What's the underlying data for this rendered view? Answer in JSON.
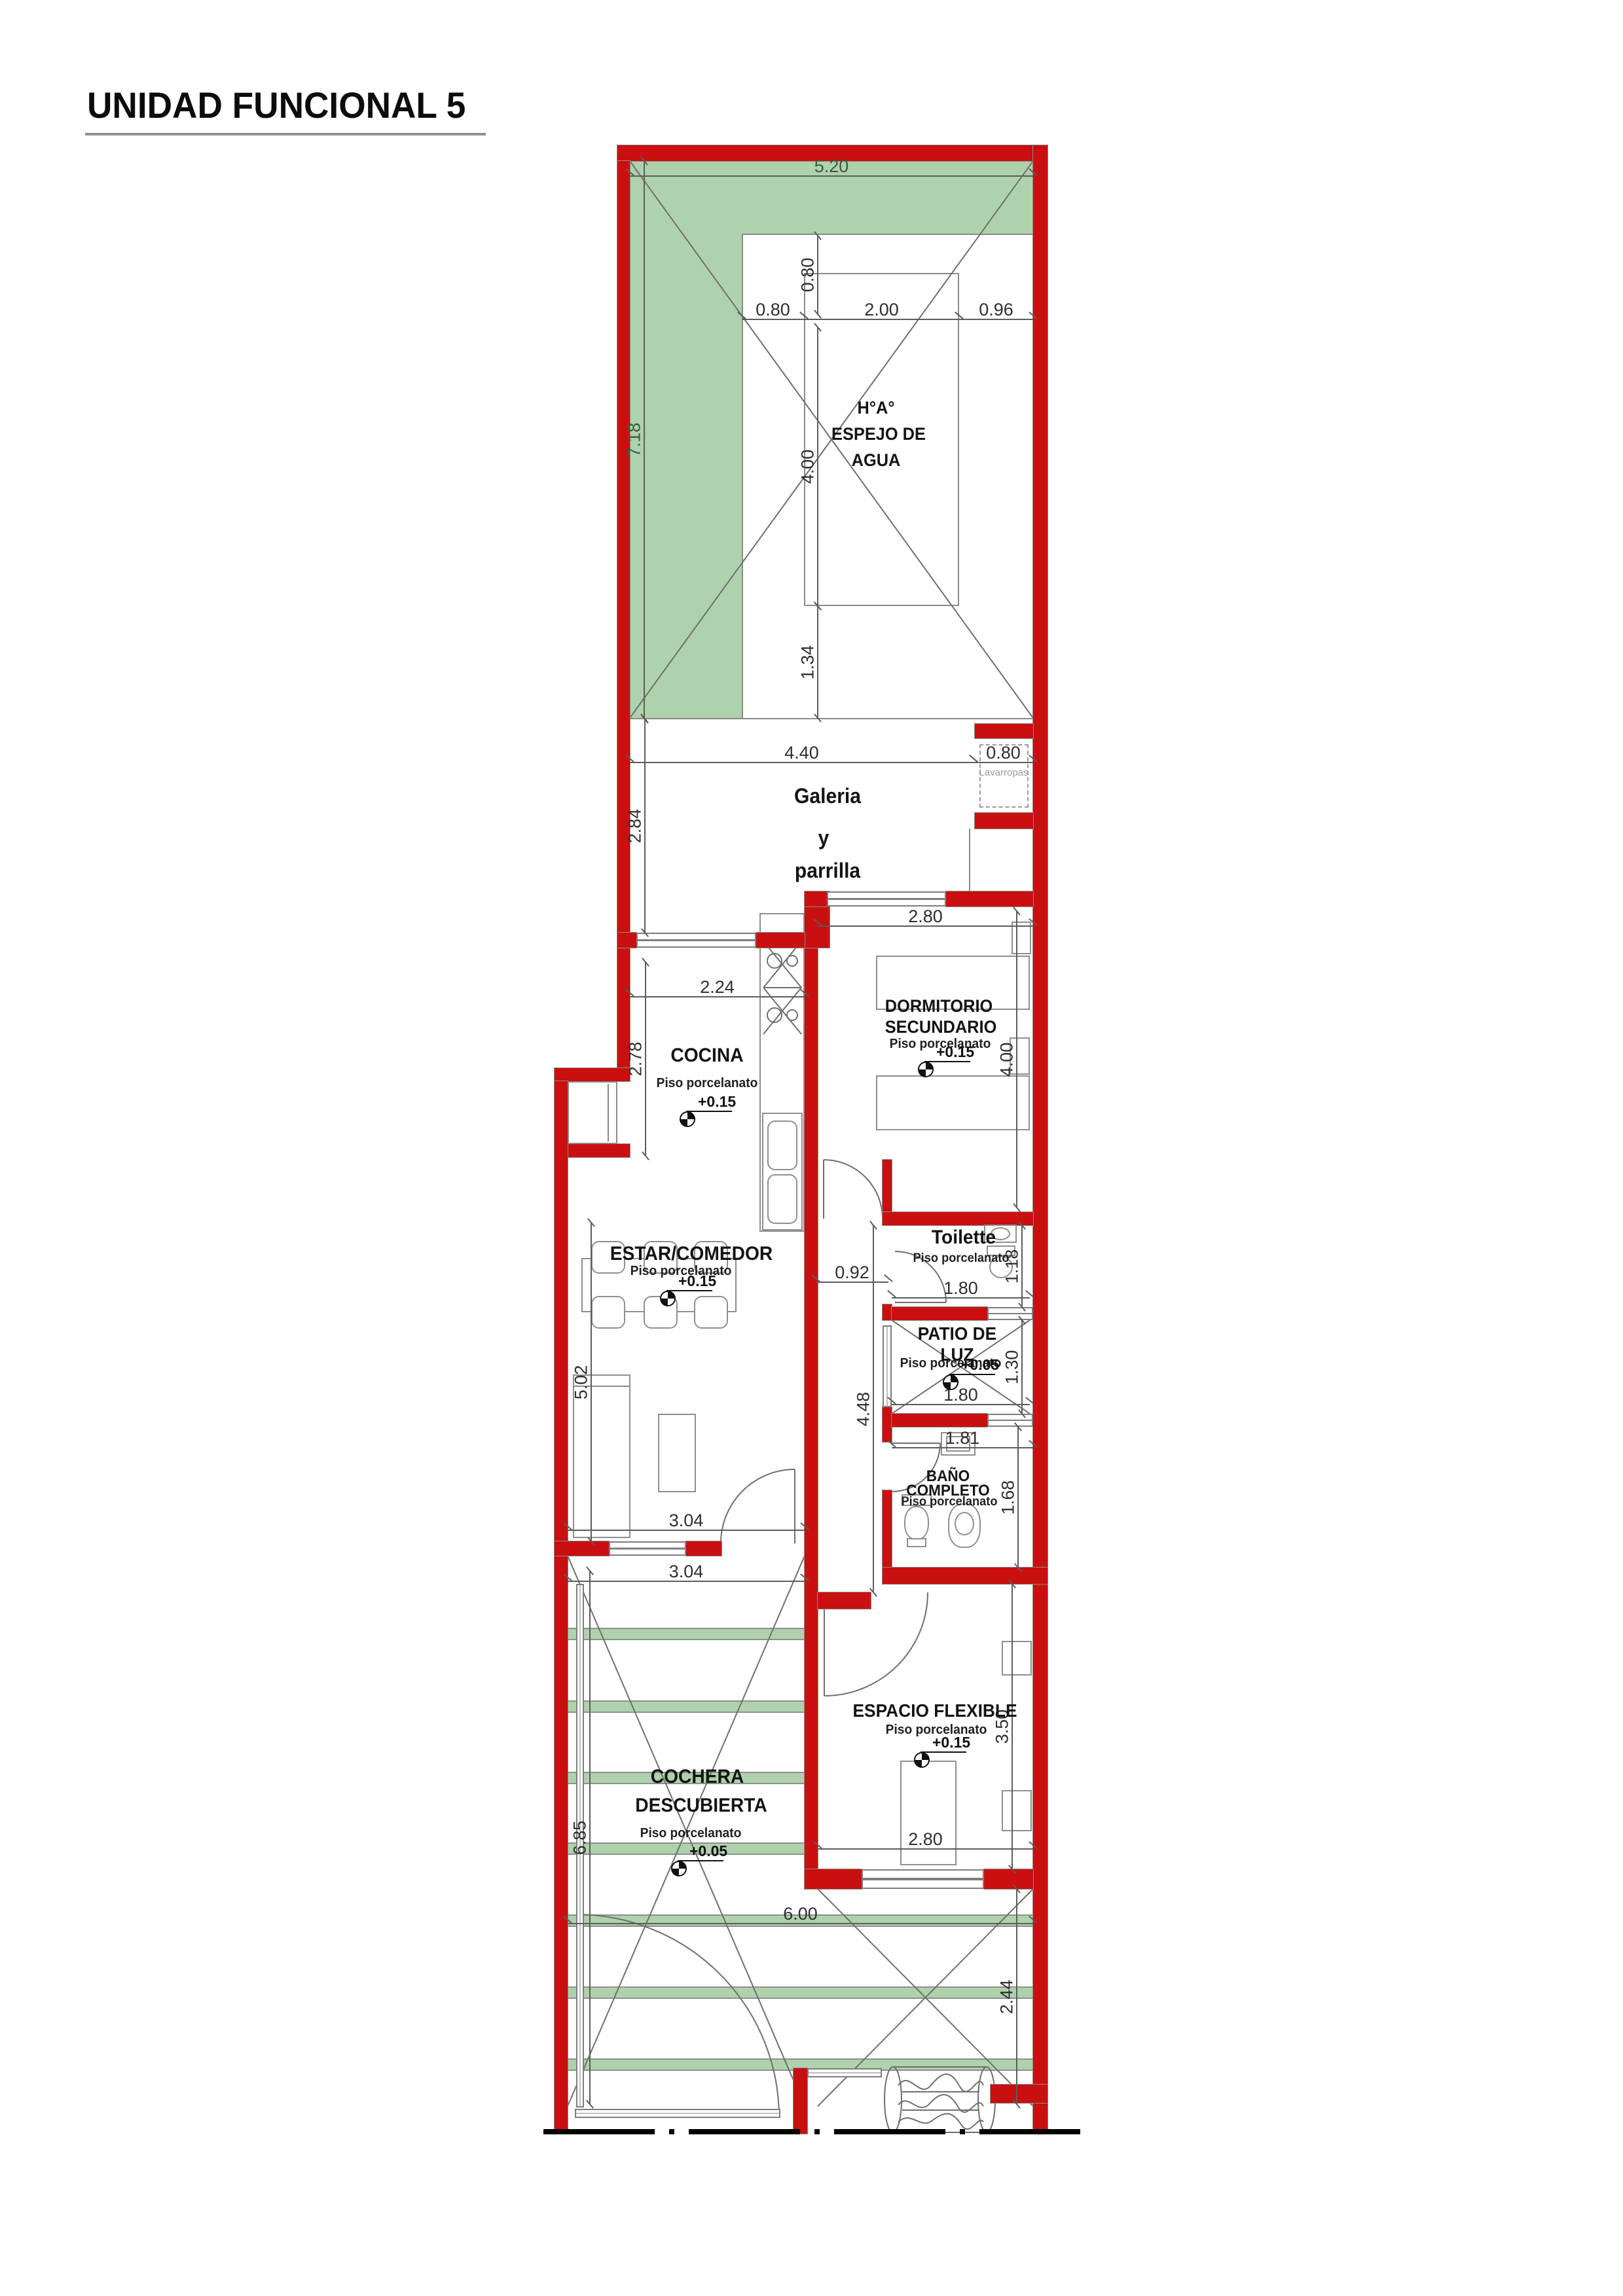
{
  "title": {
    "text": "UNIDAD FUNCIONAL 5"
  },
  "colors": {
    "wall_red": "#c90f0f",
    "terrace_green": "#aed2ab",
    "line_gray": "#8a8a8a",
    "dim_gray": "#5c5c5c"
  },
  "rooms": {
    "espejo": {
      "line1": "H°A°",
      "line2": "ESPEJO DE",
      "line3": "AGUA"
    },
    "galeria": {
      "line1": "Galeria",
      "line2": "y",
      "line3": "parrilla"
    },
    "lavarropas": {
      "label": "Lavarropas"
    },
    "cocina": {
      "name": "COCINA",
      "floor": "Piso porcelanato",
      "level": "+0.15"
    },
    "dormitorio": {
      "name1": "DORMITORIO",
      "name2": "SECUNDARIO",
      "floor": "Piso porcelanato",
      "level": "+0.15"
    },
    "estar": {
      "name": "ESTAR/COMEDOR",
      "floor": "Piso porcelanato",
      "level": "+0.15"
    },
    "toilette": {
      "name": "Toilette",
      "floor": "Piso porcelanato"
    },
    "patio": {
      "name1": "PATIO DE",
      "name2": "LUZ",
      "floor": "Piso porcelanato",
      "level": "+0.05"
    },
    "bano": {
      "name1": "BAÑO",
      "name2": "COMPLETO",
      "floor": "Piso porcelanato"
    },
    "cochera": {
      "name1": "COCHERA",
      "name2": "DESCUBIERTA",
      "floor": "Piso porcelanato",
      "level": "+0.05"
    },
    "espacio": {
      "name": "ESPACIO FLEXIBLE",
      "floor": "Piso porcelanato",
      "level": "+0.15"
    }
  },
  "dims": {
    "terrace_width": "5.20",
    "pool_top_offset": "0.80",
    "pool_left_offset": "0.80",
    "pool_width": "2.00",
    "pool_right_offset": "0.96",
    "terrace_height": "7.18",
    "pool_height": "4.00",
    "pool_bottom_offset": "1.34",
    "galeria_width": "4.40",
    "lavarropas_width": "0.80",
    "galeria_height": "2.84",
    "dorm_width": "2.80",
    "cocina_width": "2.24",
    "cocina_height": "2.78",
    "dorm_height": "4.00",
    "pasillo_width": "0.92",
    "estar_height": "5.02",
    "pasillo_height": "4.48",
    "toilette_height": "1.18",
    "toilette_width": "1.80",
    "patio_height": "1.30",
    "patio_width": "1.80",
    "bano_width": "1.81",
    "bano_height": "1.68",
    "estar_width": "3.04",
    "cochera_width": "3.04",
    "cochera_height": "6.85",
    "espacio_height": "3.50",
    "espacio_width": "2.80",
    "frente_width": "6.00",
    "frente_height": "2.44"
  }
}
